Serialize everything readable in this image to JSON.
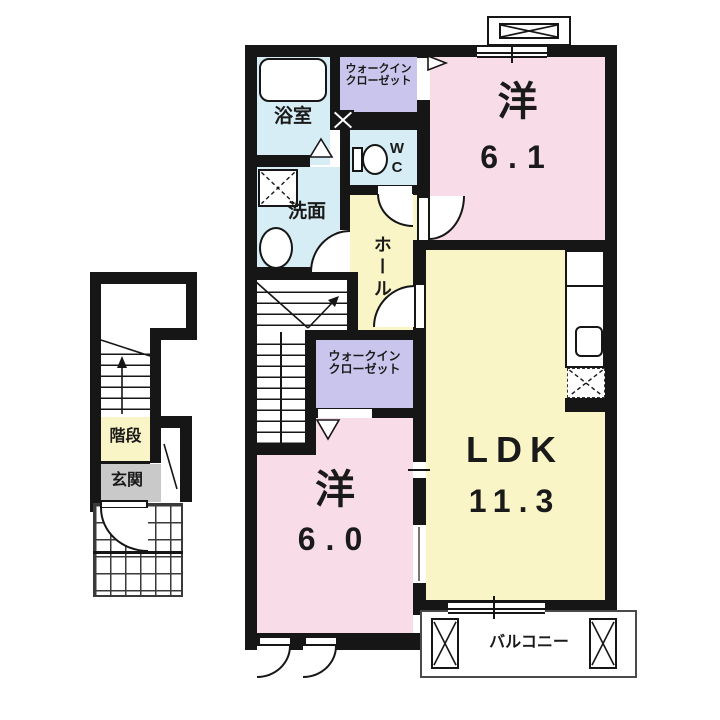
{
  "plan": {
    "colors": {
      "wall": "#161616",
      "pink": "#f8dde9",
      "yellow": "#faf5c6",
      "purple": "#c9c5ec",
      "blue": "#d7edf5",
      "gray": "#c9c9c9",
      "bg": "#ffffff"
    },
    "rooms": {
      "bath": {
        "label": "浴室"
      },
      "wic_top": {
        "line1": "ウォークイン",
        "line2": "クローゼット"
      },
      "wc": {
        "label": "WC"
      },
      "vanity": {
        "label": "洗面"
      },
      "hall": {
        "label": "ホール"
      },
      "bedroom1": {
        "label": "洋",
        "size": "6.1"
      },
      "ldk": {
        "label": "LDK",
        "size": "11.3"
      },
      "wic_mid": {
        "line1": "ウォークイン",
        "line2": "クローゼット"
      },
      "bedroom2": {
        "label": "洋",
        "size": "6.0"
      },
      "stairs": {
        "label": "階段"
      },
      "entrance": {
        "label": "玄関"
      },
      "balcony": {
        "label": "バルコニー"
      }
    }
  }
}
